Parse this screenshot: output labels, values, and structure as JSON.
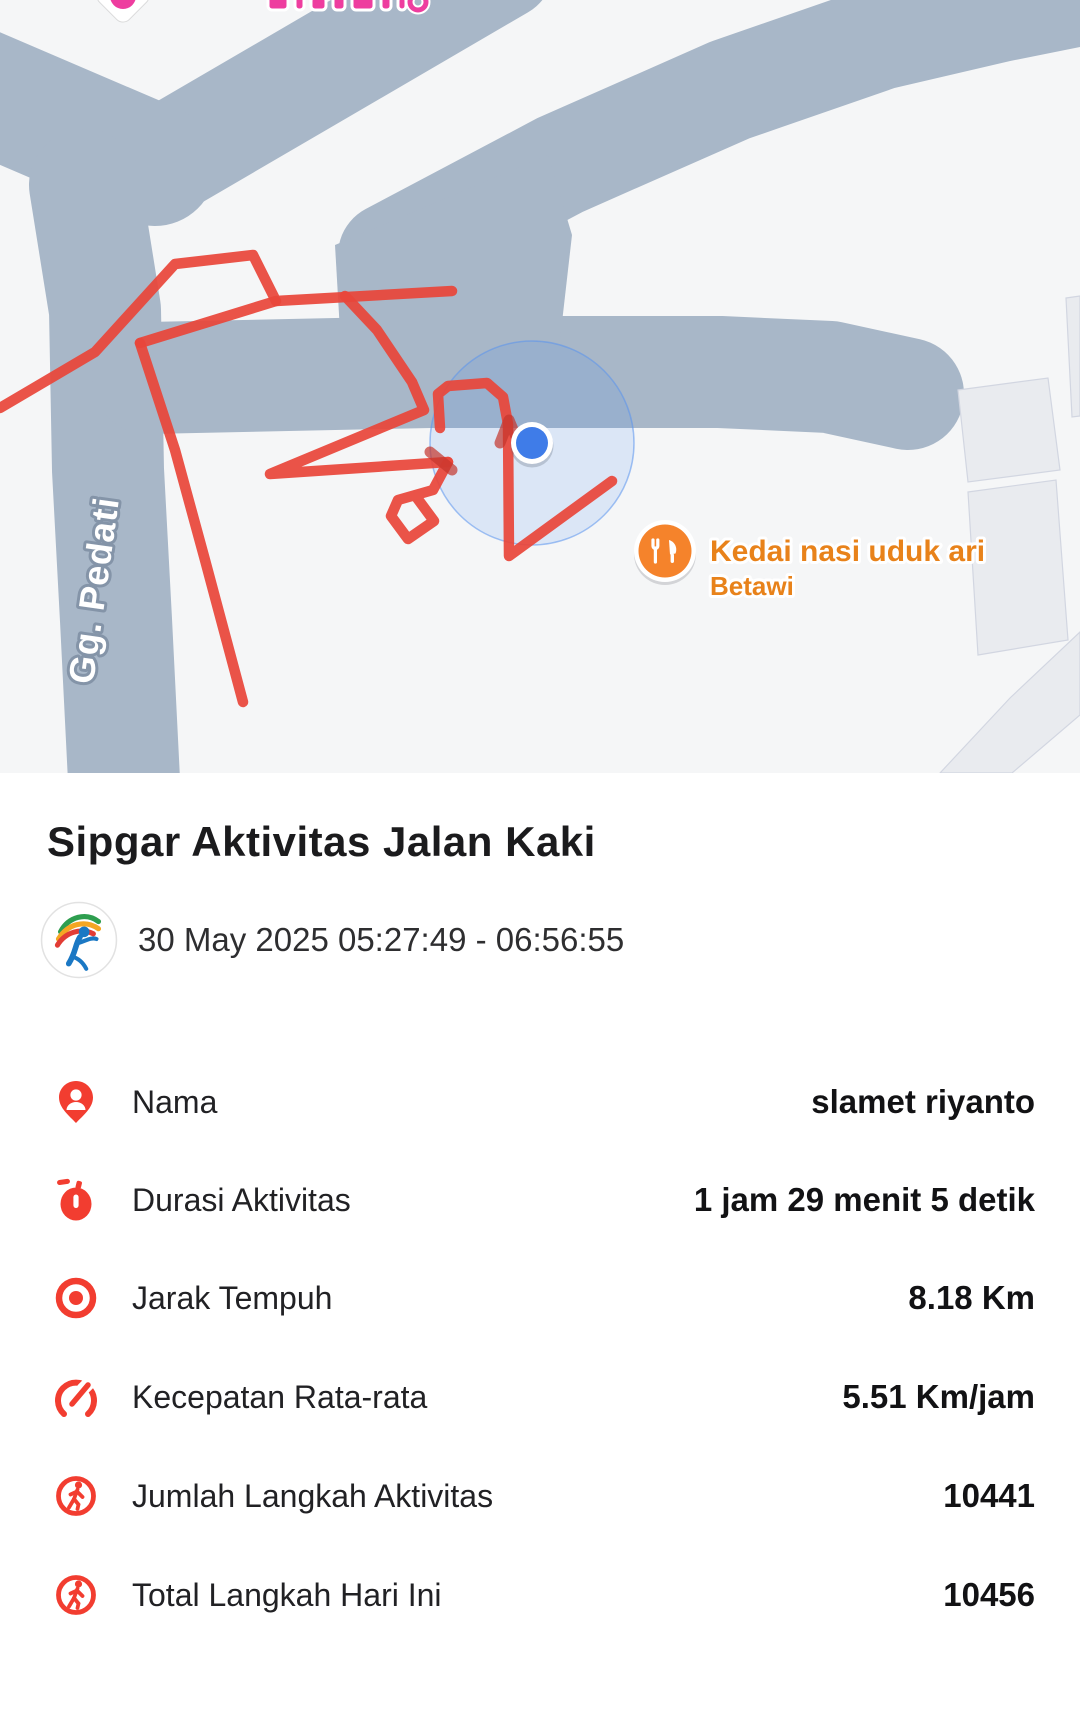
{
  "map": {
    "background_color": "#f5f6f7",
    "road_color": "#a8b7c8",
    "route_color": "#e8463a",
    "route_overlap_color": "#c5342c",
    "building_color": "#e9ebef",
    "road_label": "Gg. Pedati",
    "poi": {
      "line1": "Kedai nasi uduk ari",
      "line2": "Betawi",
      "icon": "restaurant-icon",
      "icon_color": "#f5832b",
      "label_color": "#e8821a"
    },
    "partial_top_marker_color": "#ee3d9f",
    "gps": {
      "cx": 532,
      "cy": 443,
      "accuracy_radius": 102,
      "dot_radius": 16,
      "dot_color": "#3f7ce8"
    },
    "roads": [
      {
        "pts": [
          [
            152,
            168
          ],
          [
            500,
            -35
          ]
        ],
        "w": 110
      },
      {
        "pts": [
          [
            -48,
            78
          ],
          [
            155,
            165
          ]
        ],
        "w": 122
      },
      {
        "pts": [
          [
            85,
            185
          ],
          [
            105,
            310
          ],
          [
            108,
            470
          ],
          [
            116,
            620
          ],
          [
            124,
            780
          ]
        ],
        "w": 112
      },
      {
        "pts": [
          [
            390,
            255
          ],
          [
            560,
            165
          ],
          [
            730,
            90
          ],
          [
            880,
            38
          ],
          [
            1000,
            10
          ],
          [
            1140,
            -18
          ]
        ],
        "w": 104
      },
      {
        "pts": [
          [
            148,
            378
          ],
          [
            430,
            372
          ],
          [
            720,
            372
          ],
          [
            830,
            377
          ],
          [
            908,
            394
          ]
        ],
        "w": 112
      }
    ],
    "road_patches": [
      [
        [
          335,
          245
        ],
        [
          548,
          155
        ],
        [
          572,
          235
        ],
        [
          560,
          340
        ],
        [
          460,
          425
        ],
        [
          345,
          418
        ]
      ]
    ],
    "buildings": [
      [
        [
          958,
          390
        ],
        [
          1048,
          378
        ],
        [
          1060,
          470
        ],
        [
          968,
          482
        ]
      ],
      [
        [
          968,
          492
        ],
        [
          1056,
          480
        ],
        [
          1068,
          640
        ],
        [
          978,
          655
        ]
      ],
      [
        [
          1066,
          298
        ],
        [
          1080,
          296
        ],
        [
          1080,
          416
        ],
        [
          1072,
          417
        ]
      ],
      [
        [
          940,
          773
        ],
        [
          1010,
          698
        ],
        [
          1080,
          632
        ],
        [
          1080,
          715
        ],
        [
          1012,
          773
        ]
      ]
    ],
    "route_paths": [
      [
        [
          0,
          408
        ],
        [
          95,
          352
        ],
        [
          175,
          264
        ],
        [
          253,
          255
        ],
        [
          276,
          301
        ],
        [
          452,
          291
        ]
      ],
      [
        [
          140,
          343
        ],
        [
          276,
          301
        ]
      ],
      [
        [
          140,
          343
        ],
        [
          175,
          450
        ],
        [
          205,
          560
        ],
        [
          243,
          702
        ]
      ],
      [
        [
          345,
          296
        ],
        [
          377,
          330
        ],
        [
          412,
          382
        ],
        [
          424,
          410
        ],
        [
          270,
          474
        ],
        [
          448,
          462
        ]
      ],
      [
        [
          448,
          462
        ],
        [
          433,
          490
        ],
        [
          398,
          500
        ],
        [
          391,
          516
        ],
        [
          408,
          539
        ],
        [
          434,
          521
        ],
        [
          417,
          498
        ]
      ],
      [
        [
          440,
          428
        ],
        [
          438,
          394
        ],
        [
          448,
          386
        ],
        [
          487,
          383
        ],
        [
          503,
          397
        ],
        [
          508,
          424
        ],
        [
          509,
          556
        ],
        [
          612,
          481
        ]
      ]
    ],
    "route_overlaps": [
      [
        [
          430,
          452
        ],
        [
          452,
          470
        ]
      ],
      [
        [
          500,
          443
        ],
        [
          509,
          420
        ],
        [
          519,
          444
        ]
      ]
    ]
  },
  "activity": {
    "title": "Sipgar Aktivitas Jalan Kaki",
    "datetime_range": "30 May 2025 05:27:49 - 06:56:55",
    "app_logo": "sipgar-logo",
    "stats": [
      {
        "icon": "person-pin-icon",
        "label": "Nama",
        "value": "slamet riyanto"
      },
      {
        "icon": "stopwatch-icon",
        "label": "Durasi Aktivitas",
        "value": "1 jam 29 menit 5 detik"
      },
      {
        "icon": "target-icon",
        "label": "Jarak Tempuh",
        "value": "8.18 Km"
      },
      {
        "icon": "speedometer-icon",
        "label": "Kecepatan Rata-rata",
        "value": "5.51 Km/jam"
      },
      {
        "icon": "steps-icon",
        "label": "Jumlah Langkah Aktivitas",
        "value": "10441"
      },
      {
        "icon": "steps-icon",
        "label": "Total Langkah Hari Ini",
        "value": "10456"
      }
    ],
    "accent_red": "#f23d30"
  }
}
